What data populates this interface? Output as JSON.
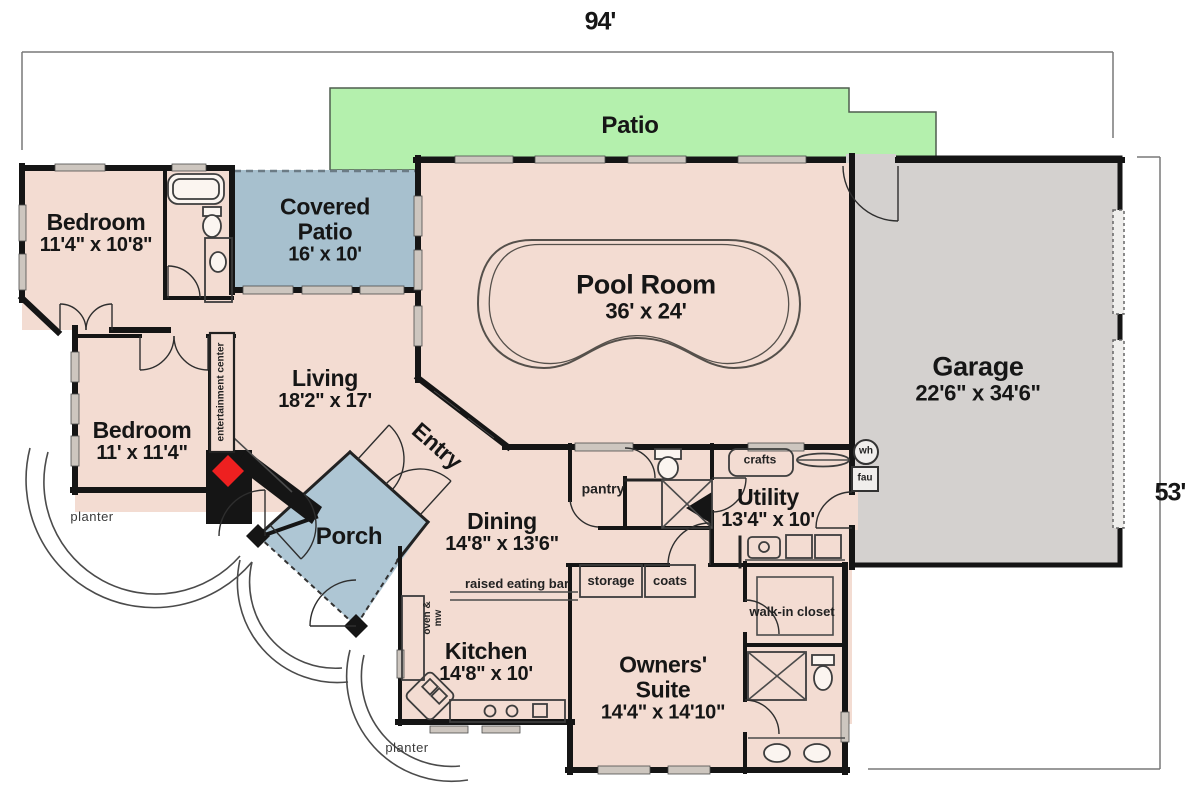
{
  "dimensions": {
    "width_label": "94'",
    "height_label": "53'"
  },
  "rooms": {
    "patio": {
      "label": "Patio"
    },
    "covered_patio": {
      "label": "Covered Patio",
      "size": "16' x 10'"
    },
    "pool_room": {
      "label": "Pool Room",
      "size": "36' x 24'"
    },
    "garage": {
      "label": "Garage",
      "size": "22'6\" x 34'6\""
    },
    "bedroom_top": {
      "label": "Bedroom",
      "size": "11'4\" x 10'8\""
    },
    "bedroom_left": {
      "label": "Bedroom",
      "size": "11' x 11'4\""
    },
    "living": {
      "label": "Living",
      "size": "18'2\" x 17'"
    },
    "entry": {
      "label": "Entry"
    },
    "porch": {
      "label": "Porch"
    },
    "dining": {
      "label": "Dining",
      "size": "14'8\" x 13'6\""
    },
    "kitchen": {
      "label": "Kitchen",
      "size": "14'8\" x 10'"
    },
    "utility": {
      "label": "Utility",
      "size": "13'4\" x 10'"
    },
    "owners_suite": {
      "label": "Owners' Suite",
      "size": "14'4\" x 14'10\""
    }
  },
  "features": {
    "pantry": "pantry",
    "crafts": "crafts",
    "storage": "storage",
    "coats": "coats",
    "walk_in_closet": "walk-in closet",
    "raised_eating_bar": "raised eating bar",
    "oven_mw": "oven & mw",
    "entertainment_center": "entertainment center",
    "water_heater": "wh",
    "furnace": "fau",
    "planter_left": "planter",
    "planter_bottom": "planter"
  },
  "colors": {
    "patio_green": "#b4f0ad",
    "room_beige": "#f3dcd2",
    "covered_blue": "#a7c0ce",
    "porch_blue": "#aec6d4",
    "garage_gray": "#d4d1cf",
    "wall_black": "#151515",
    "fireplace_red": "#ee2020",
    "dim_gray": "#787878"
  }
}
